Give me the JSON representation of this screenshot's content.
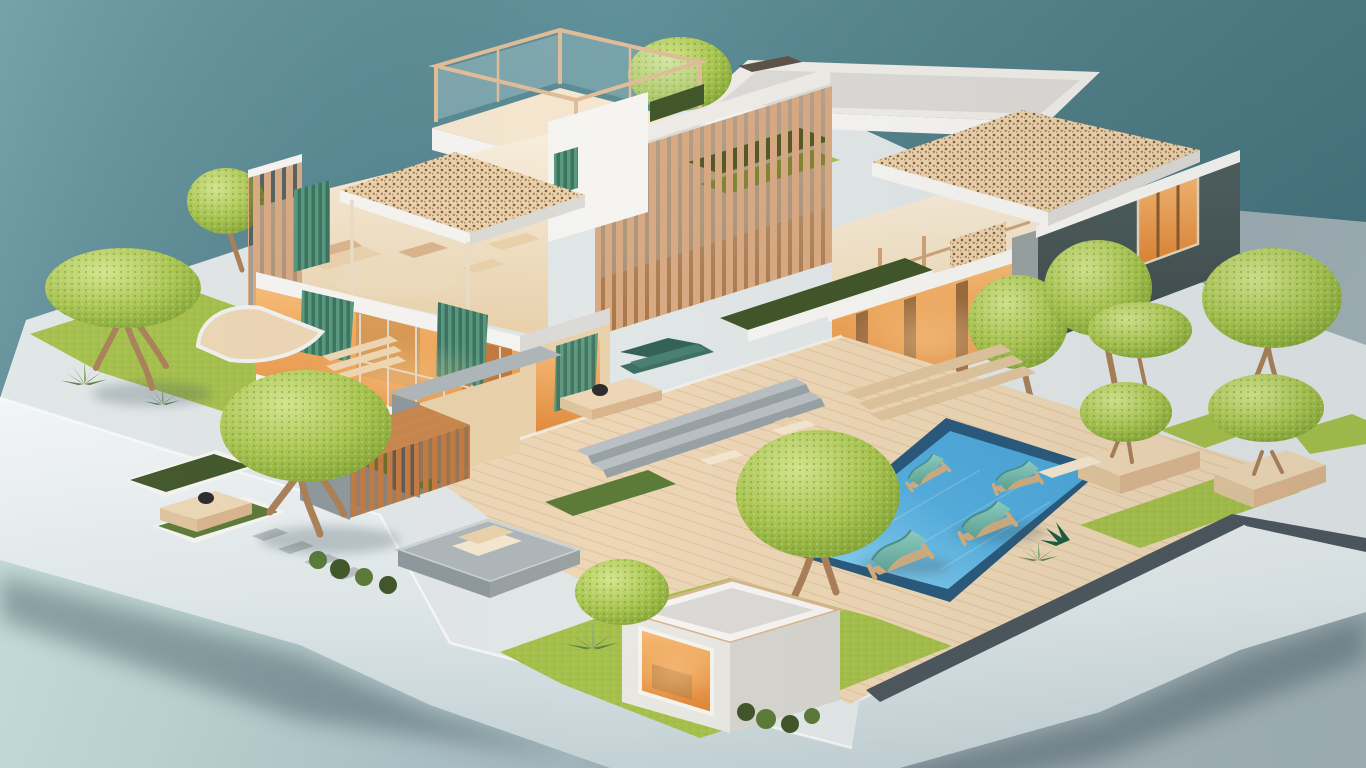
{
  "meta": {
    "type": "3d-render",
    "description": "Isometric 3D architectural model of a modern cut-away villa with wooden slat facades, perforated lattice roofs, teal curtains, warm-lit interiors, landscaped gardens with round topiary trees, a blue swimming pool with teal sun loungers, a pergola, planters and a small garden pavilion, all on a pale display platform against a teal studio backdrop."
  },
  "palette": {
    "skyTop": "#60919a",
    "skyMid": "#548691",
    "skyDeep": "#4a7984",
    "tableA": "#cbe0dc",
    "tableB": "#b8d0cf",
    "tableC": "#a6bac0",
    "tableD": "#9aa9b1",
    "tableE": "#a2b2b6",
    "slabTop": "#e1e6e7",
    "slabHi": "#f0f3f3",
    "slabFaceA": "#f3f5f6",
    "slabFaceB": "#dfe7e9",
    "slabFaceC": "#c2d1d5",
    "shadowCol": "#43565e",
    "walkway": "#4d575e",
    "edging": "#707a82",
    "stone": "#b9bfc2",
    "stoneD": "#98a1a6",
    "deckWood": "#ecd6b5",
    "deckWoodSh": "#dfc49d",
    "plank": "#c59a6e",
    "frameWood": "#e0bd98",
    "woodTrim": "#d9b58e",
    "finWood": "#d8aa84",
    "finDarkA": "#c27a42",
    "lattice": "#ecd2ab",
    "latticeDot": "#6e4b31",
    "white": "#f5f4f1",
    "whiteSh": "#dcdad6",
    "parapet": "#efece7",
    "grayFace": "#9aa1a1",
    "grayMid": "#aeb6b9",
    "grayDark": "#8f989c",
    "cream": "#f4e6cf",
    "creamSh": "#e8d1ab",
    "interiorWood": "#c99760",
    "warmA": "#f7bc76",
    "warmB": "#e08433",
    "glow": "#ffd9a0",
    "curtain": "#58997f",
    "curtainD": "#3d7361",
    "sofa": "#3e7164",
    "grass": "#a5c04c",
    "grassHi": "#c3d873",
    "grassDk": "#83a437",
    "grassEdge": "#6f9338",
    "canopy": "#a8c44f",
    "canopyHi": "#d4e58d",
    "canopyDk": "#7a9e31",
    "trunk": "#aa8058",
    "hedge": "#41572a",
    "hedgeHi": "#5c7a38",
    "agave": "#8fae71",
    "agaveDk": "#5f7f4b",
    "pool": "#55aede",
    "poolHi": "#93d6f3",
    "poolDk": "#4aa3d6",
    "poolRim": "#2b5a7d",
    "loungA": "#8fcfc4",
    "loungB": "#5ea393",
    "loungWood": "#d3ad7c",
    "darkBox": "#51605f",
    "darkBoxDp": "#3f4c4d",
    "pergRoof": "#c8864c"
  },
  "scene": {
    "objects": [
      {
        "name": "backdrop",
        "label": "teal studio backdrop"
      },
      {
        "name": "display-table",
        "label": "pale display surface"
      },
      {
        "name": "base-platform",
        "label": "white model base platform"
      },
      {
        "name": "left-wing",
        "label": "two-storey cut-away wing with curtains"
      },
      {
        "name": "rooftop-terrace",
        "label": "glazed roof terrace"
      },
      {
        "name": "lattice-canopy",
        "label": "perforated lattice canopy"
      },
      {
        "name": "slat-facade",
        "label": "vertical wooden slat facade"
      },
      {
        "name": "right-wing",
        "label": "open interior with shelving"
      },
      {
        "name": "dark-annex",
        "label": "dark grey annex box"
      },
      {
        "name": "lattice-roof",
        "label": "perforated roof over annex"
      },
      {
        "name": "porch",
        "label": "warm lit porch"
      },
      {
        "name": "swimming-pool",
        "label": "blue swimming pool"
      },
      {
        "name": "pool-deck",
        "label": "timber pool deck"
      },
      {
        "name": "sun-loungers",
        "label": "teal sling sun loungers"
      },
      {
        "name": "rooftop-garden",
        "label": "roof garden planting"
      },
      {
        "name": "garden-left",
        "label": "left lawn garden"
      },
      {
        "name": "planter-beds",
        "label": "bordered hedge beds"
      },
      {
        "name": "stepping-stones",
        "label": "stepping stone path"
      },
      {
        "name": "garden-table",
        "label": "low wooden garden table"
      },
      {
        "name": "pergola",
        "label": "timber slat pergola"
      },
      {
        "name": "entry-wall",
        "label": "grey entry portal wall"
      },
      {
        "name": "daybed-platform",
        "label": "grey platform with cushions"
      },
      {
        "name": "hedge-strips",
        "label": "clipped hedge strips"
      },
      {
        "name": "topiary-trees",
        "label": "round topiary trees"
      },
      {
        "name": "tree-planters",
        "label": "timber tree planters with benches"
      },
      {
        "name": "garden-pavilion",
        "label": "small white pavilion"
      },
      {
        "name": "agave-plants",
        "label": "agave accent plants"
      },
      {
        "name": "curtains",
        "label": "teal drapes"
      },
      {
        "name": "glazed-windows",
        "label": "warm lit glazing"
      },
      {
        "name": "stairs",
        "label": "terrace steps"
      }
    ]
  }
}
